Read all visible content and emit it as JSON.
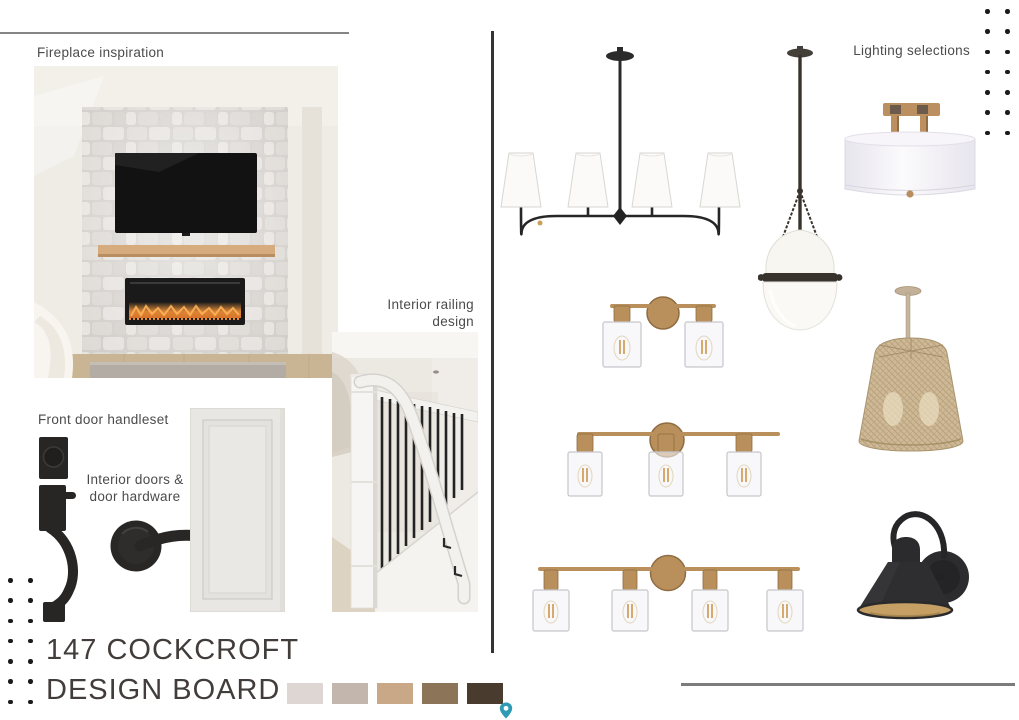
{
  "board": {
    "title_line1": "147 COCKCROFT",
    "title_line2": "DESIGN BOARD"
  },
  "labels": {
    "fireplace": "Fireplace inspiration",
    "railing_line1": "Interior railing",
    "railing_line2": "design",
    "front_door": "Front door handleset",
    "interior_doors_line1": "Interior doors &",
    "interior_doors_line2": "door hardware",
    "lighting": "Lighting selections"
  },
  "palette": {
    "swatches": [
      {
        "name": "plaster-cream",
        "hex": "#ded6d2"
      },
      {
        "name": "warm-taupe",
        "hex": "#c2b6ad"
      },
      {
        "name": "camel-tan",
        "hex": "#c9a888"
      },
      {
        "name": "walnut-brown",
        "hex": "#8b7458"
      },
      {
        "name": "espresso",
        "hex": "#493b2d"
      }
    ]
  },
  "lighting_fixtures": [
    "four-shade-linear-chandelier",
    "opal-urn-pendant",
    "brass-drum-semi-flush-mount",
    "two-light-brass-vanity",
    "three-light-brass-vanity",
    "four-light-brass-vanity",
    "woven-rattan-pendant",
    "black-barn-wall-sconce"
  ],
  "hardware_items": [
    "black-entry-handleset",
    "black-door-lever",
    "white-shaker-interior-door"
  ],
  "colors": {
    "brass": "#b9905c",
    "fixture_black": "#2a2a2e",
    "divider": "#343434",
    "rule_grey": "#7c7c7c",
    "title_text": "#423d3a",
    "label_text": "#4b4b4b",
    "pin_teal": "#2f9ab3"
  }
}
